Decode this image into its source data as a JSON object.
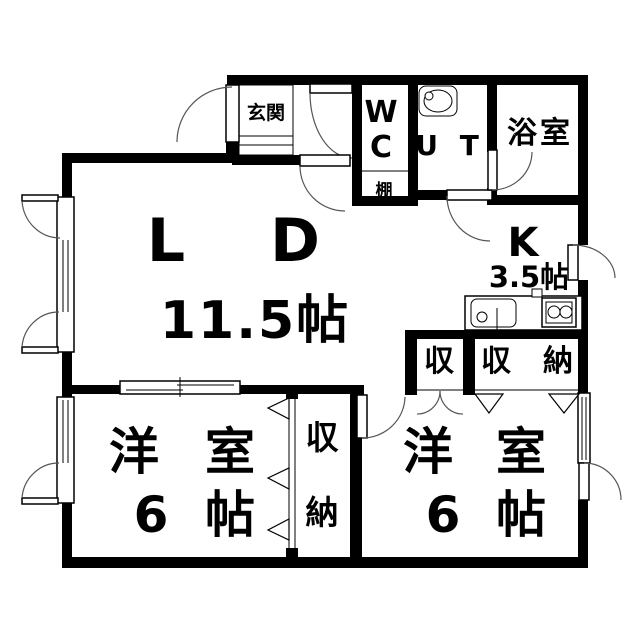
{
  "plan": {
    "type": "apartment-floor-plan",
    "colors": {
      "wall": "#000000",
      "background": "#ffffff",
      "door_arc": "#555555"
    }
  },
  "rooms": {
    "entrance": {
      "label": "玄関"
    },
    "wc": {
      "line1": "W",
      "line2": "C"
    },
    "utility": {
      "label": "U T"
    },
    "bathroom": {
      "label": "浴室"
    },
    "shelf": {
      "label": "棚"
    },
    "living_dining": {
      "label_l": "L",
      "label_d": "D",
      "size": "11.5帖"
    },
    "kitchen": {
      "label": "K",
      "size": "3.5帖"
    },
    "storage_small": {
      "label": "収"
    },
    "storage_wide": {
      "char1": "収",
      "char2": "納"
    },
    "closet_vertical": {
      "char1": "収",
      "char2": "納"
    },
    "western_room_left": {
      "char1": "洋",
      "char2": "室",
      "size_num": "6",
      "size_unit": "帖"
    },
    "western_room_right": {
      "char1": "洋",
      "char2": "室",
      "size_num": "6",
      "size_unit": "帖"
    }
  }
}
